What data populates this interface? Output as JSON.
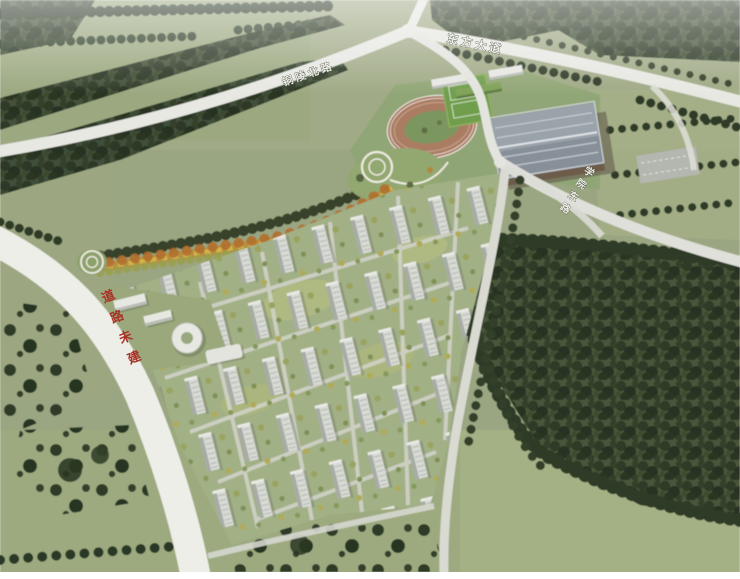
{
  "road_labels": {
    "north_road": {
      "text": "铜陵北路"
    },
    "east_avenue": {
      "text": "东方大道"
    },
    "southeast_road": {
      "text": "学院东路"
    },
    "unbuilt_road_notice": {
      "text": "道路未建"
    }
  },
  "colors": {
    "road_label": "#f2f3ec",
    "unbuilt_notice": "#a93226",
    "field_green": "#9aa581",
    "forest_green": "#3a462e",
    "road_surface": "#ecede7",
    "track_surface": "#aa7d64",
    "sports_field": "#6f9e4e",
    "building_facade": "#d8dad4",
    "gym_roof": "#939ba3",
    "greenway_orange": "#b98d3c"
  }
}
